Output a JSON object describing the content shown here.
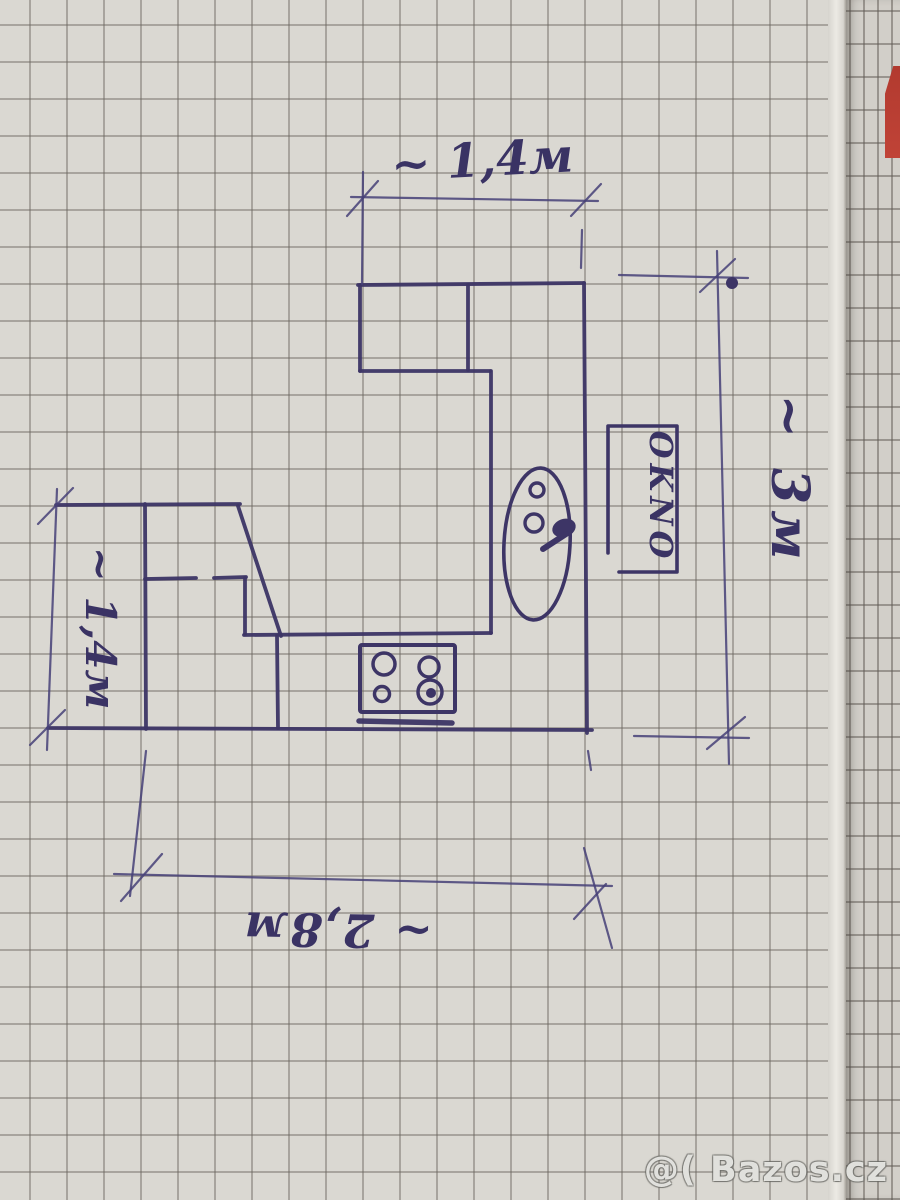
{
  "watermark": {
    "text": "@( Bazos.cz"
  },
  "sketch": {
    "labels": {
      "window": "OKNO"
    },
    "dimensions": {
      "top": "~ 1,4м",
      "left": "~ 1,4м",
      "right": "~ 3м",
      "bottom": "~ 2,8м"
    },
    "geometry": {
      "pen_color": "#3d3566",
      "dim_color": "#474178",
      "walls": [
        [
          358,
          285,
          584,
          283
        ],
        [
          584,
          283,
          587,
          733
        ],
        [
          48,
          728,
          592,
          730
        ],
        [
          145,
          504,
          146,
          729
        ],
        [
          56,
          505,
          240,
          504
        ],
        [
          238,
          506,
          281,
          636
        ],
        [
          145,
          579,
          196,
          578
        ],
        [
          214,
          578,
          246,
          577
        ],
        [
          245,
          578,
          245,
          634
        ],
        [
          244,
          635,
          491,
          633
        ],
        [
          277,
          636,
          278,
          728
        ],
        [
          360,
          285,
          360,
          371
        ],
        [
          360,
          371,
          490,
          371
        ],
        [
          468,
          285,
          468,
          370
        ],
        [
          491,
          371,
          491,
          633
        ],
        [
          359,
          721,
          452,
          723,
          5.5
        ]
      ],
      "thin_lines": [
        [
          351,
          197,
          598,
          201
        ],
        [
          347,
          216,
          378,
          181
        ],
        [
          571,
          216,
          601,
          184
        ],
        [
          363,
          172,
          362,
          284
        ],
        [
          582,
          230,
          581,
          268
        ],
        [
          717,
          251,
          729,
          764
        ],
        [
          619,
          275,
          748,
          278
        ],
        [
          634,
          736,
          749,
          738
        ],
        [
          700,
          292,
          735,
          259
        ],
        [
          707,
          749,
          745,
          717
        ],
        [
          57,
          489,
          47,
          750
        ],
        [
          38,
          524,
          73,
          488
        ],
        [
          30,
          745,
          65,
          710
        ],
        [
          114,
          874,
          612,
          886
        ],
        [
          146,
          751,
          130,
          896
        ],
        [
          121,
          901,
          162,
          854
        ],
        [
          588,
          751,
          591,
          770
        ],
        [
          584,
          848,
          612,
          948
        ],
        [
          574,
          919,
          606,
          884
        ]
      ],
      "window_outline": [
        [
          608,
          553
        ],
        [
          608,
          426
        ],
        [
          677,
          426
        ],
        [
          677,
          572
        ],
        [
          619,
          572
        ]
      ],
      "ink_dot": [
        732,
        283,
        6
      ],
      "sink": {
        "cx": 537,
        "cy": 544,
        "rx": 33,
        "ry": 76,
        "tilt": 3,
        "rings": [
          [
            537,
            490,
            7
          ],
          [
            534,
            523,
            9
          ]
        ],
        "faucet": {
          "cx": 564,
          "cy": 528,
          "rx": 12,
          "ry": 9,
          "tilt": -20,
          "spout": [
            566,
            534,
            543,
            549
          ]
        }
      },
      "stove": {
        "x": 360,
        "y": 645,
        "w": 95,
        "h": 67,
        "burners": [
          [
            384,
            664,
            11
          ],
          [
            429,
            667,
            10
          ],
          [
            382,
            694,
            7.5
          ],
          [
            430,
            692,
            12
          ]
        ],
        "inner_dot": [
          431,
          693,
          5
        ]
      }
    }
  }
}
